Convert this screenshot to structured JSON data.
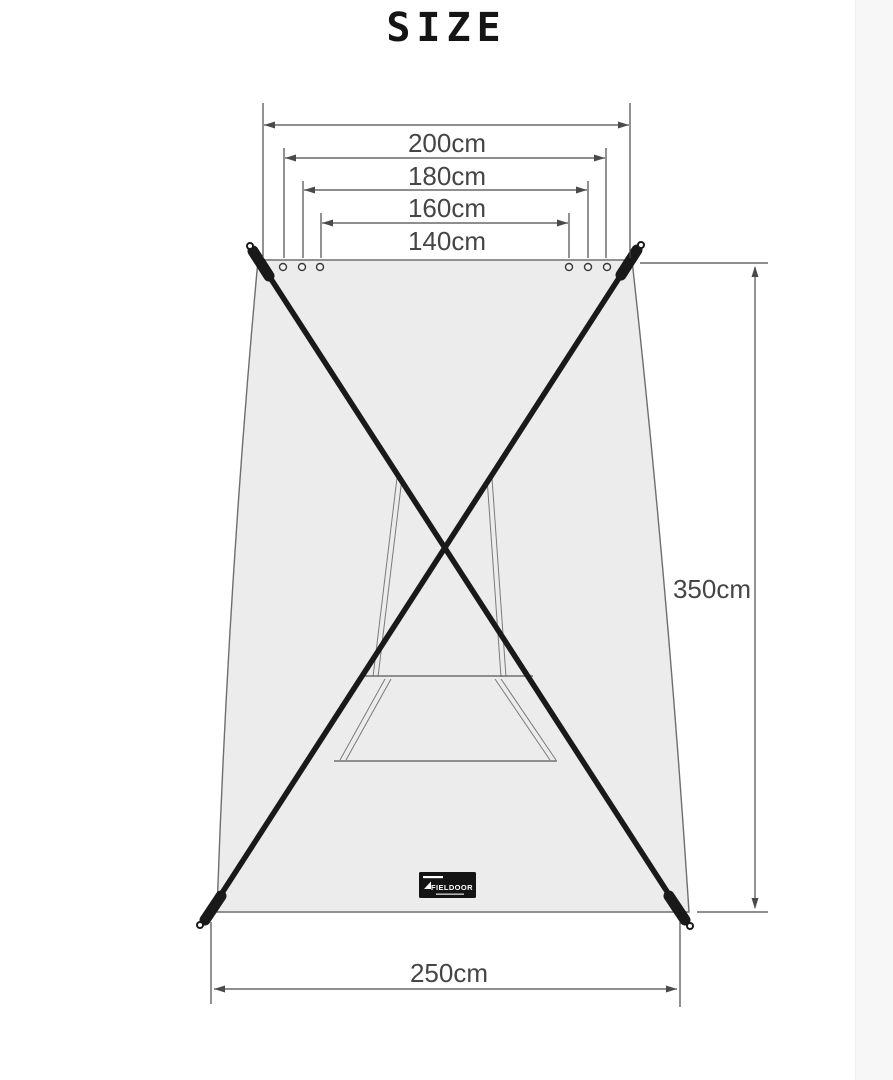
{
  "page": {
    "title": "SIZE",
    "background_color": "#ffffff"
  },
  "diagram": {
    "kind": "product-size-diagram",
    "subject": "sun shade tarp with crossed support poles over a stand frame",
    "dimensions": {
      "top_widths": [
        {
          "label": "200cm"
        },
        {
          "label": "180cm"
        },
        {
          "label": "160cm"
        },
        {
          "label": "140cm"
        }
      ],
      "height": {
        "label": "350cm"
      },
      "bottom_width": {
        "label": "250cm"
      }
    },
    "brand": {
      "name": "FIELDOOR"
    },
    "colors": {
      "tarp_fill": "#ececec",
      "tarp_outline": "#6e6e6e",
      "pole": "#191919",
      "dimension_lines": "#4a4a4a",
      "inner_frame": "#7a7a7a"
    },
    "icons": {
      "grommet": "small ringed circle",
      "pole_eyelet": "small ringed circle",
      "arrowhead": "solid triangle"
    }
  }
}
